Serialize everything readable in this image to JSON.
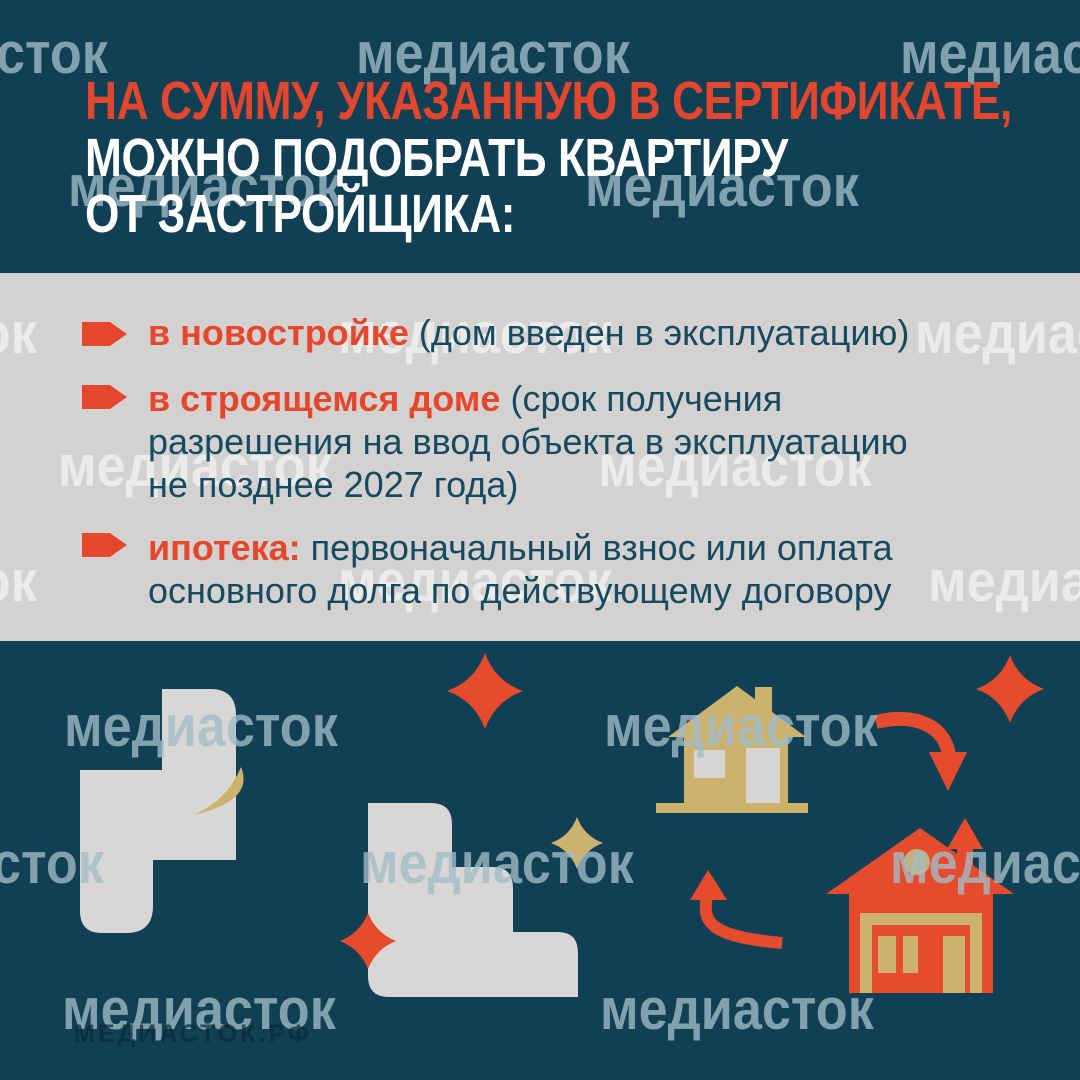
{
  "brand": {
    "watermark_word": "медиасток",
    "watermark_fragment": "сток",
    "site_url": "МЕДИАСТОК.РФ"
  },
  "header": {
    "line1": "НА СУММУ, УКАЗАННУЮ В СЕРТИФИКАТЕ,",
    "line2": "МОЖНО ПОДОБРАТЬ КВАРТИРУ",
    "line3": "ОТ ЗАСТРОЙЩИКА:"
  },
  "bullets": [
    {
      "lead": "в новостройке",
      "rest": "(дом введен в эксплуатацию)"
    },
    {
      "lead": "в строящемся доме",
      "rest": "(срок получения\nразрешения на ввод объекта в эксплуатацию\nне позднее 2027 года)"
    },
    {
      "lead": "ипотека:",
      "rest": "первоначальный взнос или оплата\nосновного долга по действующему договору"
    }
  ],
  "colors": {
    "background_navy": "#114054",
    "background_gray": "#d3d2d0",
    "accent_red_text": "#e2462e",
    "illustration_red": "#e74b2e",
    "gold": "#ccb26d",
    "muted_gold_circle": "#c2b183",
    "shape_light_gray": "#d8d7d5",
    "body_text_navy": "#164a60",
    "heading_white": "#ffffff"
  }
}
